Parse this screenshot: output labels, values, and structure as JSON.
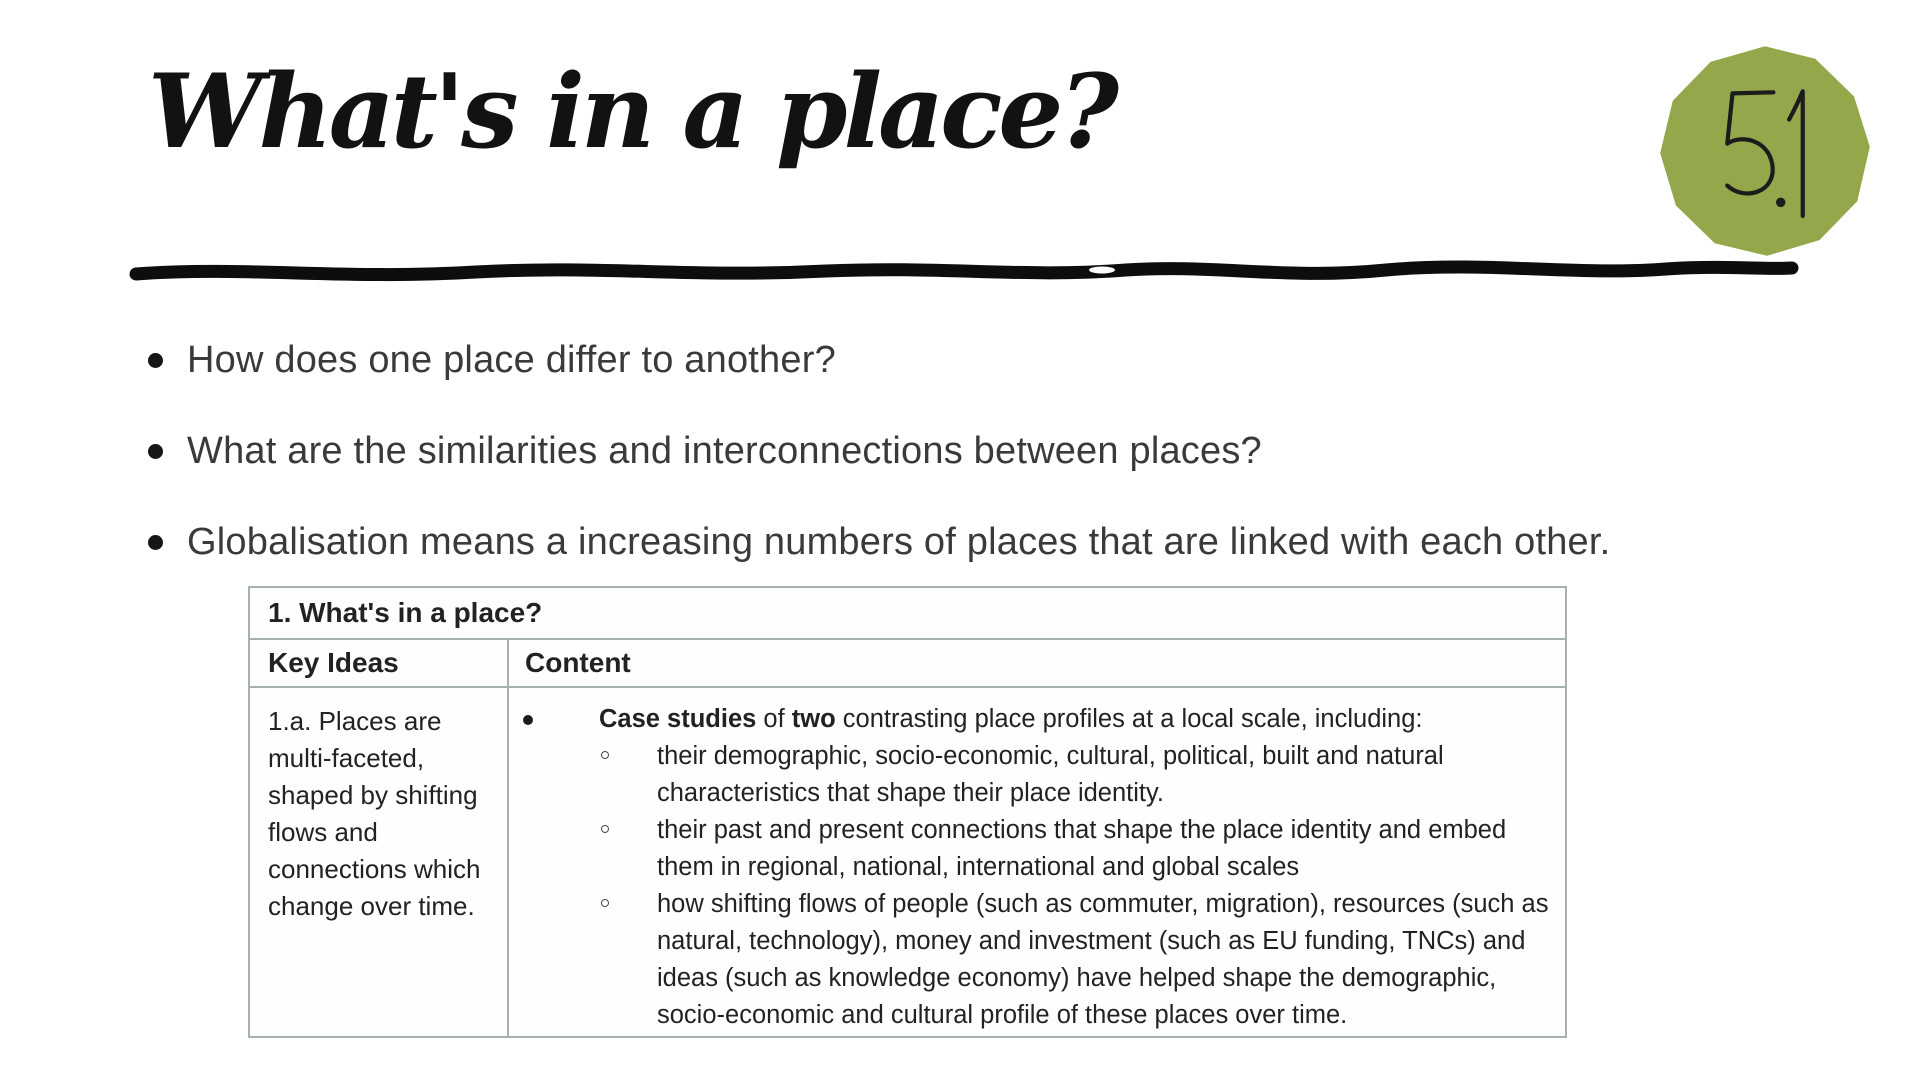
{
  "slide": {
    "title": "What's in a place?",
    "badge": {
      "number": "5.1",
      "color": "#94a84b"
    },
    "bullets": [
      "How does one place differ to another?",
      "What are the similarities and interconnections between places?",
      "Globalisation means a increasing numbers of places that are linked with each other."
    ],
    "table": {
      "title": "1. What's in a place?",
      "columns": [
        "Key Ideas",
        "Content"
      ],
      "rows": [
        {
          "key_ideas": "1.a. Places are multi-faceted, shaped by shifting flows and connections which change over time.",
          "content_items": [
            {
              "level": 1,
              "segments": [
                {
                  "text": "Case studies",
                  "bold": true
                },
                {
                  "text": " of ",
                  "bold": false
                },
                {
                  "text": "two",
                  "bold": true
                },
                {
                  "text": " contrasting place profiles at a local scale, including:",
                  "bold": false
                }
              ]
            },
            {
              "level": 2,
              "segments": [
                {
                  "text": "their demographic, socio-economic, cultural, political, built and natural characteristics that shape their place identity.",
                  "bold": false
                }
              ]
            },
            {
              "level": 2,
              "segments": [
                {
                  "text": "their past and present connections that shape the place identity and embed them in regional, national, international and global scales",
                  "bold": false
                }
              ]
            },
            {
              "level": 2,
              "segments": [
                {
                  "text": "how shifting flows of people (such as commuter, migration), resources (such as natural, technology), money and investment (such as EU funding, TNCs) and ideas (such as knowledge economy) have helped shape the demographic, socio-economic and cultural profile of these places over time.",
                  "bold": false
                }
              ]
            }
          ]
        }
      ]
    },
    "colors": {
      "badge_green": "#94a84b",
      "table_border": "#a5b3ac",
      "text": "#222222"
    }
  }
}
